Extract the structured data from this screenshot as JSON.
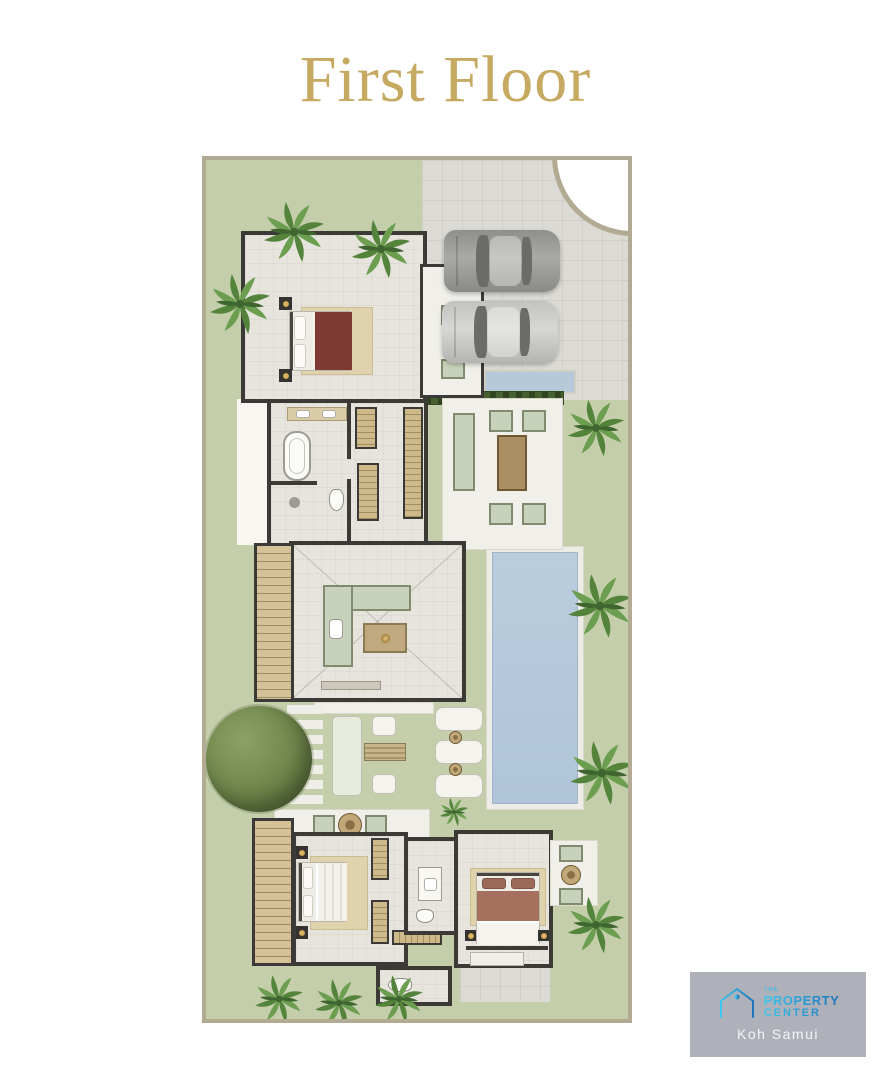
{
  "title": {
    "text": "First Floor",
    "color": "#C6AA62"
  },
  "plan": {
    "type": "architectural-floor-plan",
    "features": [
      "master-bedroom",
      "master-bathroom",
      "walk-in-closet",
      "entry-porch",
      "kitchen",
      "staircase-upper",
      "staircase-lower",
      "outdoor-lounge-terrace",
      "hedge-planter",
      "water-feature",
      "swimming-pool",
      "garden-terrace",
      "sun-loungers",
      "parking-two-cars",
      "driveway-curve",
      "bedroom-2",
      "bedroom-3",
      "bathroom-2",
      "guest-wc",
      "garden-tree",
      "palm-trees"
    ],
    "colors": {
      "lawn": "#C4CEAB",
      "floor": "#E6E4DD",
      "paving": "#DCDAD4",
      "wall": "#3B3A36",
      "boundary": "#B2AA92",
      "pool": "#B5C9DB",
      "deck": "#F0EFE9",
      "wood": "#D6C298",
      "sage_furniture": "#C8D2BA",
      "hedge": "#46602F",
      "palm": "#5C8F43",
      "tree": "#6E8449",
      "bed_master": "#7C3A32",
      "bed_guest": "#A6705F",
      "rug": "#DFD2AC"
    }
  },
  "logo": {
    "brand_line1": "THE",
    "brand_line2": "PROPERTY",
    "brand_line3": "CENTER",
    "location": "Koh Samui",
    "background": "#AEB1B9",
    "gradient_start": "#3EC6EE",
    "gradient_end": "#1B75BC",
    "location_color": "#F5F5F5"
  }
}
